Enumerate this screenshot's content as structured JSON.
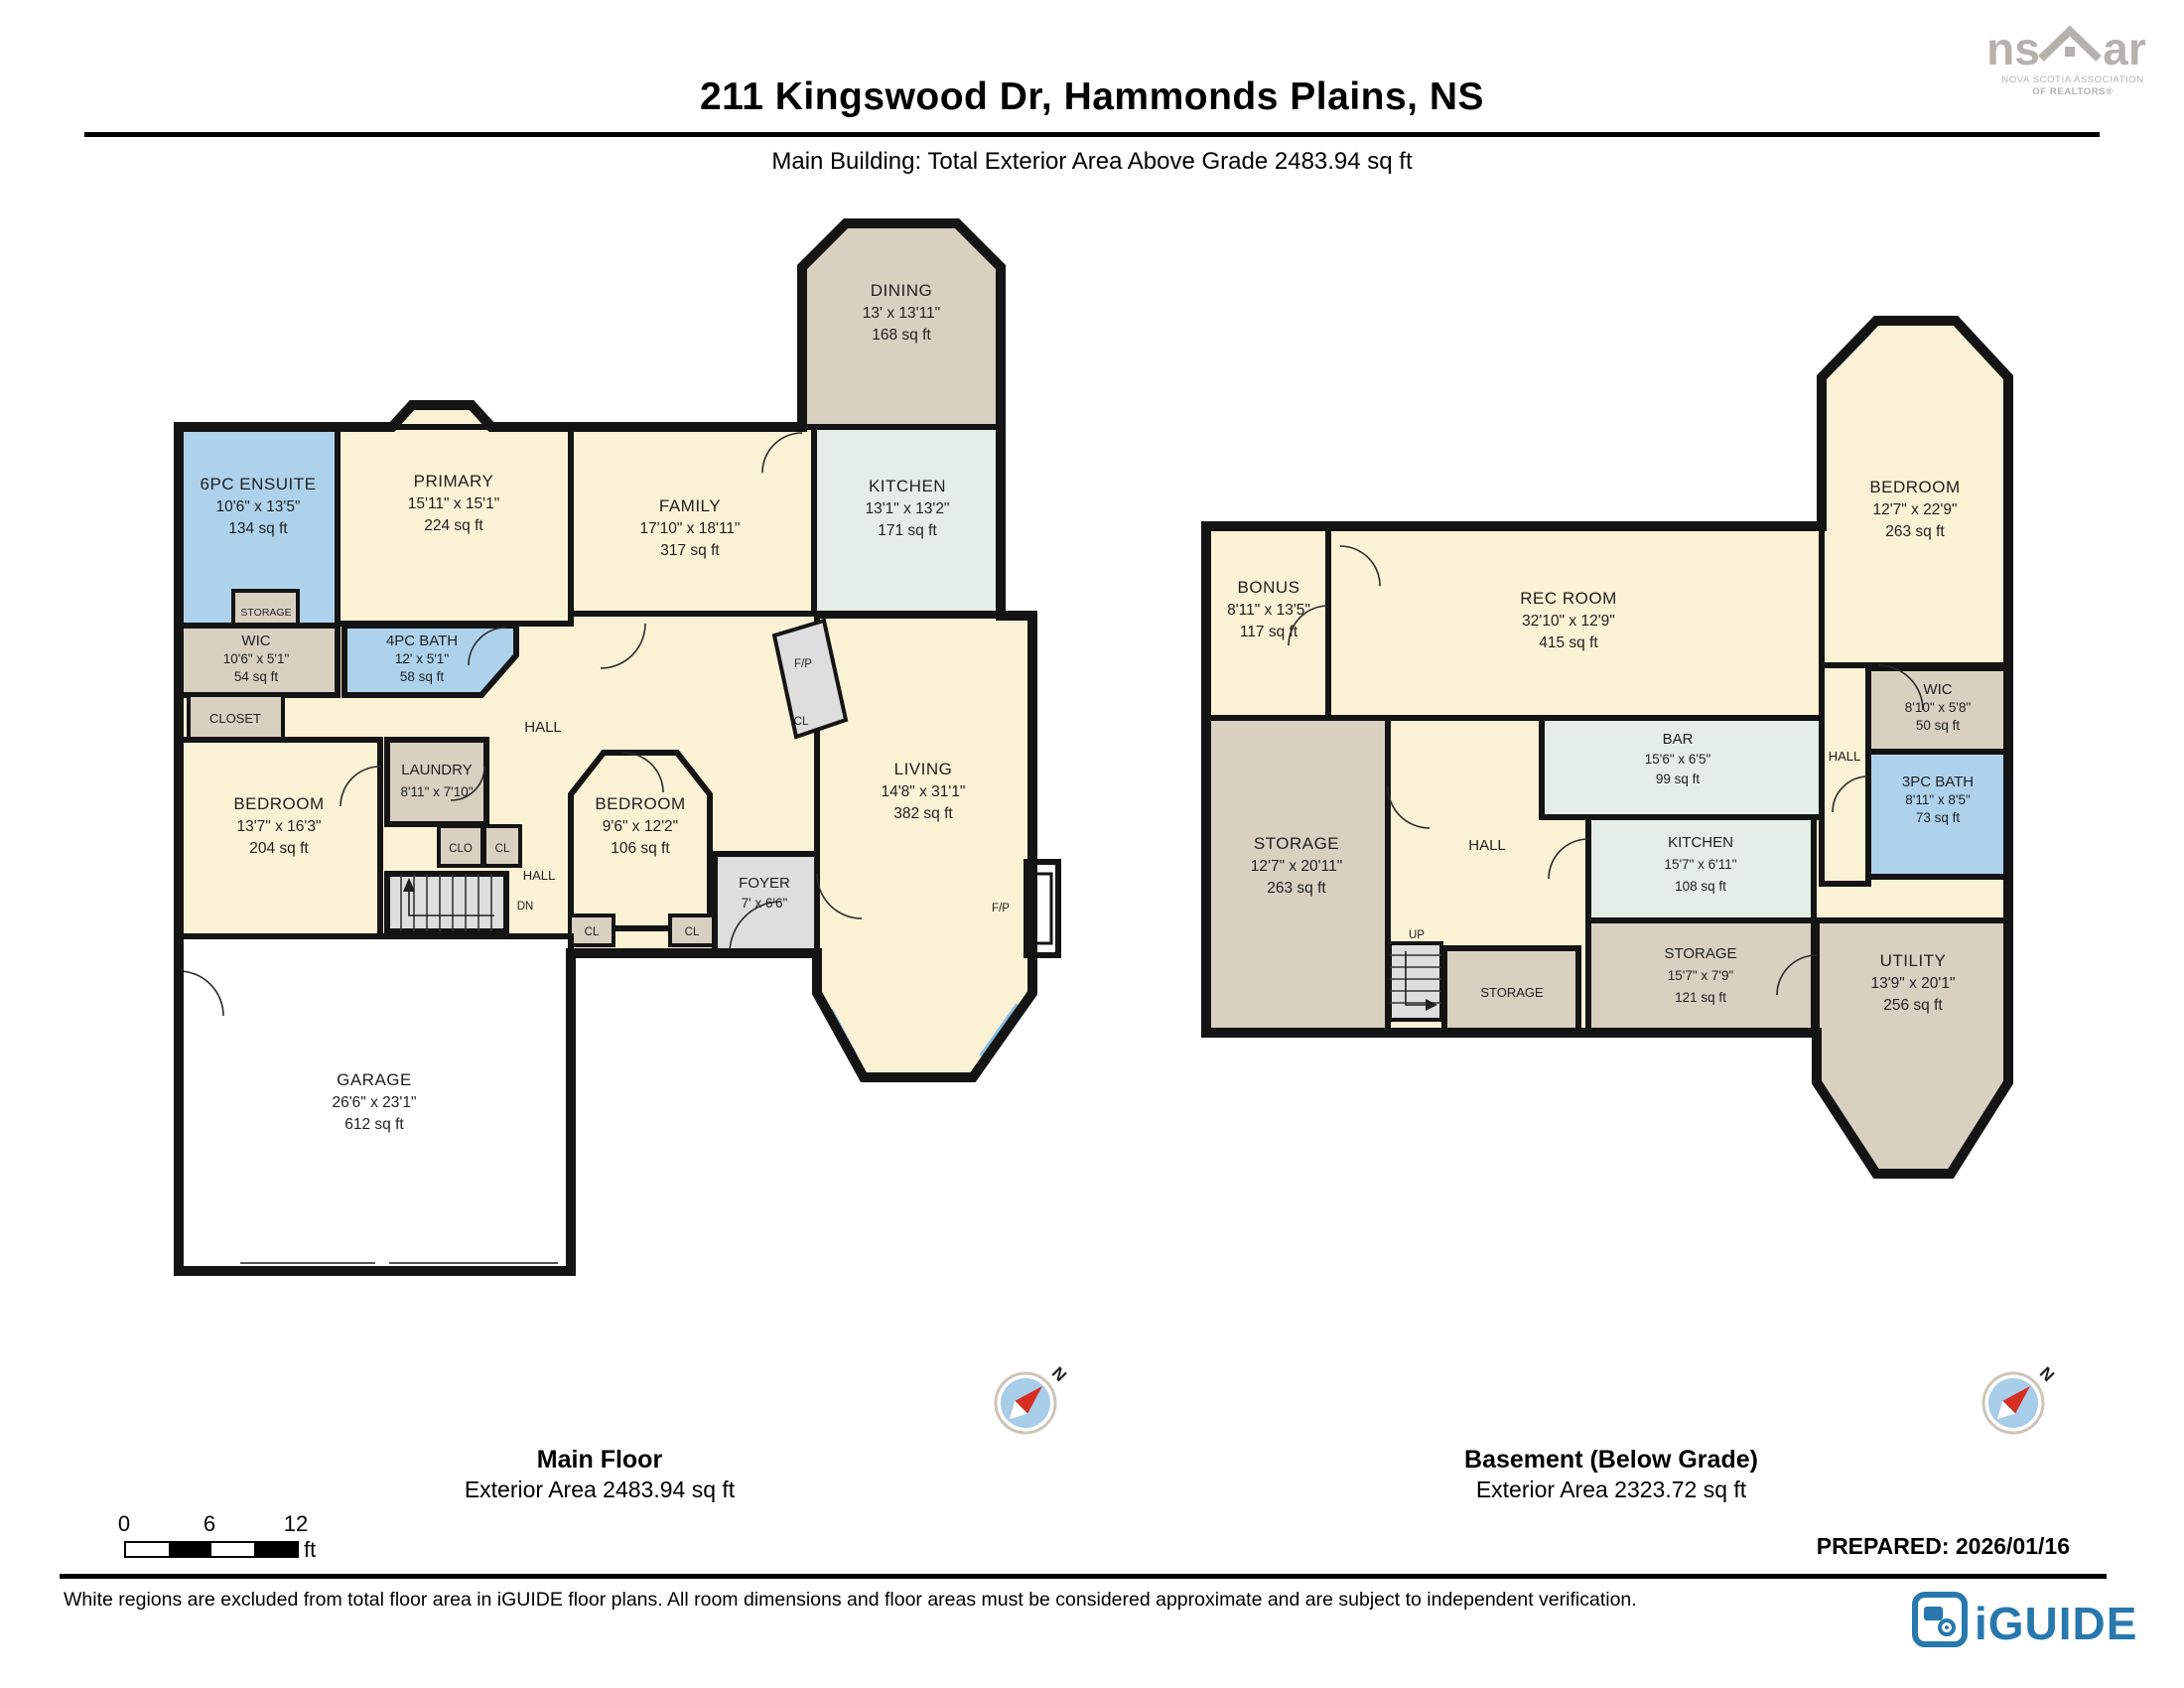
{
  "header": {
    "title": "211 Kingswood Dr, Hammonds Plains, NS",
    "subtitle": "Main Building: Total Exterior Area Above Grade 2483.94 sq ft"
  },
  "nsar_logo": {
    "text_left": "ns",
    "text_right": "ar",
    "tagline_line1": "NOVA SCOTIA ASSOCIATION",
    "tagline_line2": "OF REALTORS®"
  },
  "palette": {
    "room_cream": "#fbf1d5",
    "room_tan": "#d9d0c2",
    "room_blue": "#aed2ec",
    "room_mint": "#e4eee6",
    "room_gray": "#dedede",
    "excluded_white": "#ffffff",
    "wall_black": "#141414",
    "window_blue": "#8cbfe3",
    "compass_red": "#d62e20",
    "iguide_blue": "#2878ad",
    "nsar_gray": "#b5b2ae"
  },
  "main_floor": {
    "caption": {
      "title": "Main Floor",
      "area": "Exterior Area 2483.94 sq ft"
    },
    "compass_label": "N",
    "rooms": [
      {
        "name": "6PC ENSUITE",
        "dims": "10'6\" x 13'5\"",
        "area": "134 sq ft"
      },
      {
        "name": "PRIMARY",
        "dims": "15'11\" x 15'1\"",
        "area": "224 sq ft"
      },
      {
        "name": "DINING",
        "dims": "13' x 13'11\"",
        "area": "168 sq ft"
      },
      {
        "name": "KITCHEN",
        "dims": "13'1\" x 13'2\"",
        "area": "171 sq ft"
      },
      {
        "name": "FAMILY",
        "dims": "17'10\" x 18'11\"",
        "area": "317 sq ft"
      },
      {
        "name": "WIC",
        "dims": "10'6\" x 5'1\"",
        "area": "54 sq ft"
      },
      {
        "name": "4PC BATH",
        "dims": "12' x 5'1\"",
        "area": "58 sq ft"
      },
      {
        "name": "BEDROOM",
        "dims": "13'7\" x 16'3\"",
        "area": "204 sq ft"
      },
      {
        "name": "LAUNDRY",
        "dims": "8'11\" x 7'10\""
      },
      {
        "name": "BEDROOM",
        "dims": "9'6\" x 12'2\"",
        "area": "106 sq ft"
      },
      {
        "name": "FOYER",
        "dims": "7' x 6'6\""
      },
      {
        "name": "LIVING",
        "dims": "14'8\" x 31'1\"",
        "area": "382 sq ft"
      },
      {
        "name": "GARAGE",
        "dims": "26'6\" x 23'1\"",
        "area": "612 sq ft"
      }
    ],
    "labels": {
      "storage": "STORAGE",
      "closet": "CLOSET",
      "hall_upper": "HALL",
      "clo": "CLO",
      "cl_laundry": "CL",
      "hall_lower": "HALL",
      "dn": "DN",
      "cl_entry_left": "CL",
      "cl_entry_right": "CL",
      "fp_upper": "F/P",
      "cl_fireplace": "CL",
      "fp_right": "F/P"
    }
  },
  "basement": {
    "caption": {
      "title": "Basement (Below Grade)",
      "area": "Exterior Area 2323.72 sq ft"
    },
    "compass_label": "N",
    "rooms": [
      {
        "name": "BONUS",
        "dims": "8'11\" x 13'5\"",
        "area": "117 sq ft"
      },
      {
        "name": "REC ROOM",
        "dims": "32'10\" x 12'9\"",
        "area": "415 sq ft"
      },
      {
        "name": "BEDROOM",
        "dims": "12'7\" x 22'9\"",
        "area": "263 sq ft"
      },
      {
        "name": "WIC",
        "dims": "8'10\" x 5'8\"",
        "area": "50 sq ft"
      },
      {
        "name": "3PC BATH",
        "dims": "8'11\" x 8'5\"",
        "area": "73 sq ft"
      },
      {
        "name": "BAR",
        "dims": "15'6\" x 6'5\"",
        "area": "99 sq ft"
      },
      {
        "name": "KITCHEN",
        "dims": "15'7\" x 6'11\"",
        "area": "108 sq ft"
      },
      {
        "name": "STORAGE",
        "dims": "12'7\" x 20'11\"",
        "area": "263 sq ft"
      },
      {
        "name": "STORAGE",
        "dims": "15'7\" x 7'9\"",
        "area": "121 sq ft"
      },
      {
        "name": "UTILITY",
        "dims": "13'9\" x 20'1\"",
        "area": "256 sq ft"
      }
    ],
    "labels": {
      "hall_center": "HALL",
      "hall_right": "HALL",
      "up": "UP",
      "storage_small": "STORAGE"
    }
  },
  "footer": {
    "scale": {
      "tick0": "0",
      "tick6": "6",
      "tick12": "12",
      "unit": "ft"
    },
    "prepared": "PREPARED: 2026/01/16",
    "disclaimer": "White regions are excluded from total floor area in iGUIDE floor plans. All room dimensions and floor areas must be considered approximate and are subject to independent verification.",
    "iguide_logo_text": "iGUIDE"
  }
}
